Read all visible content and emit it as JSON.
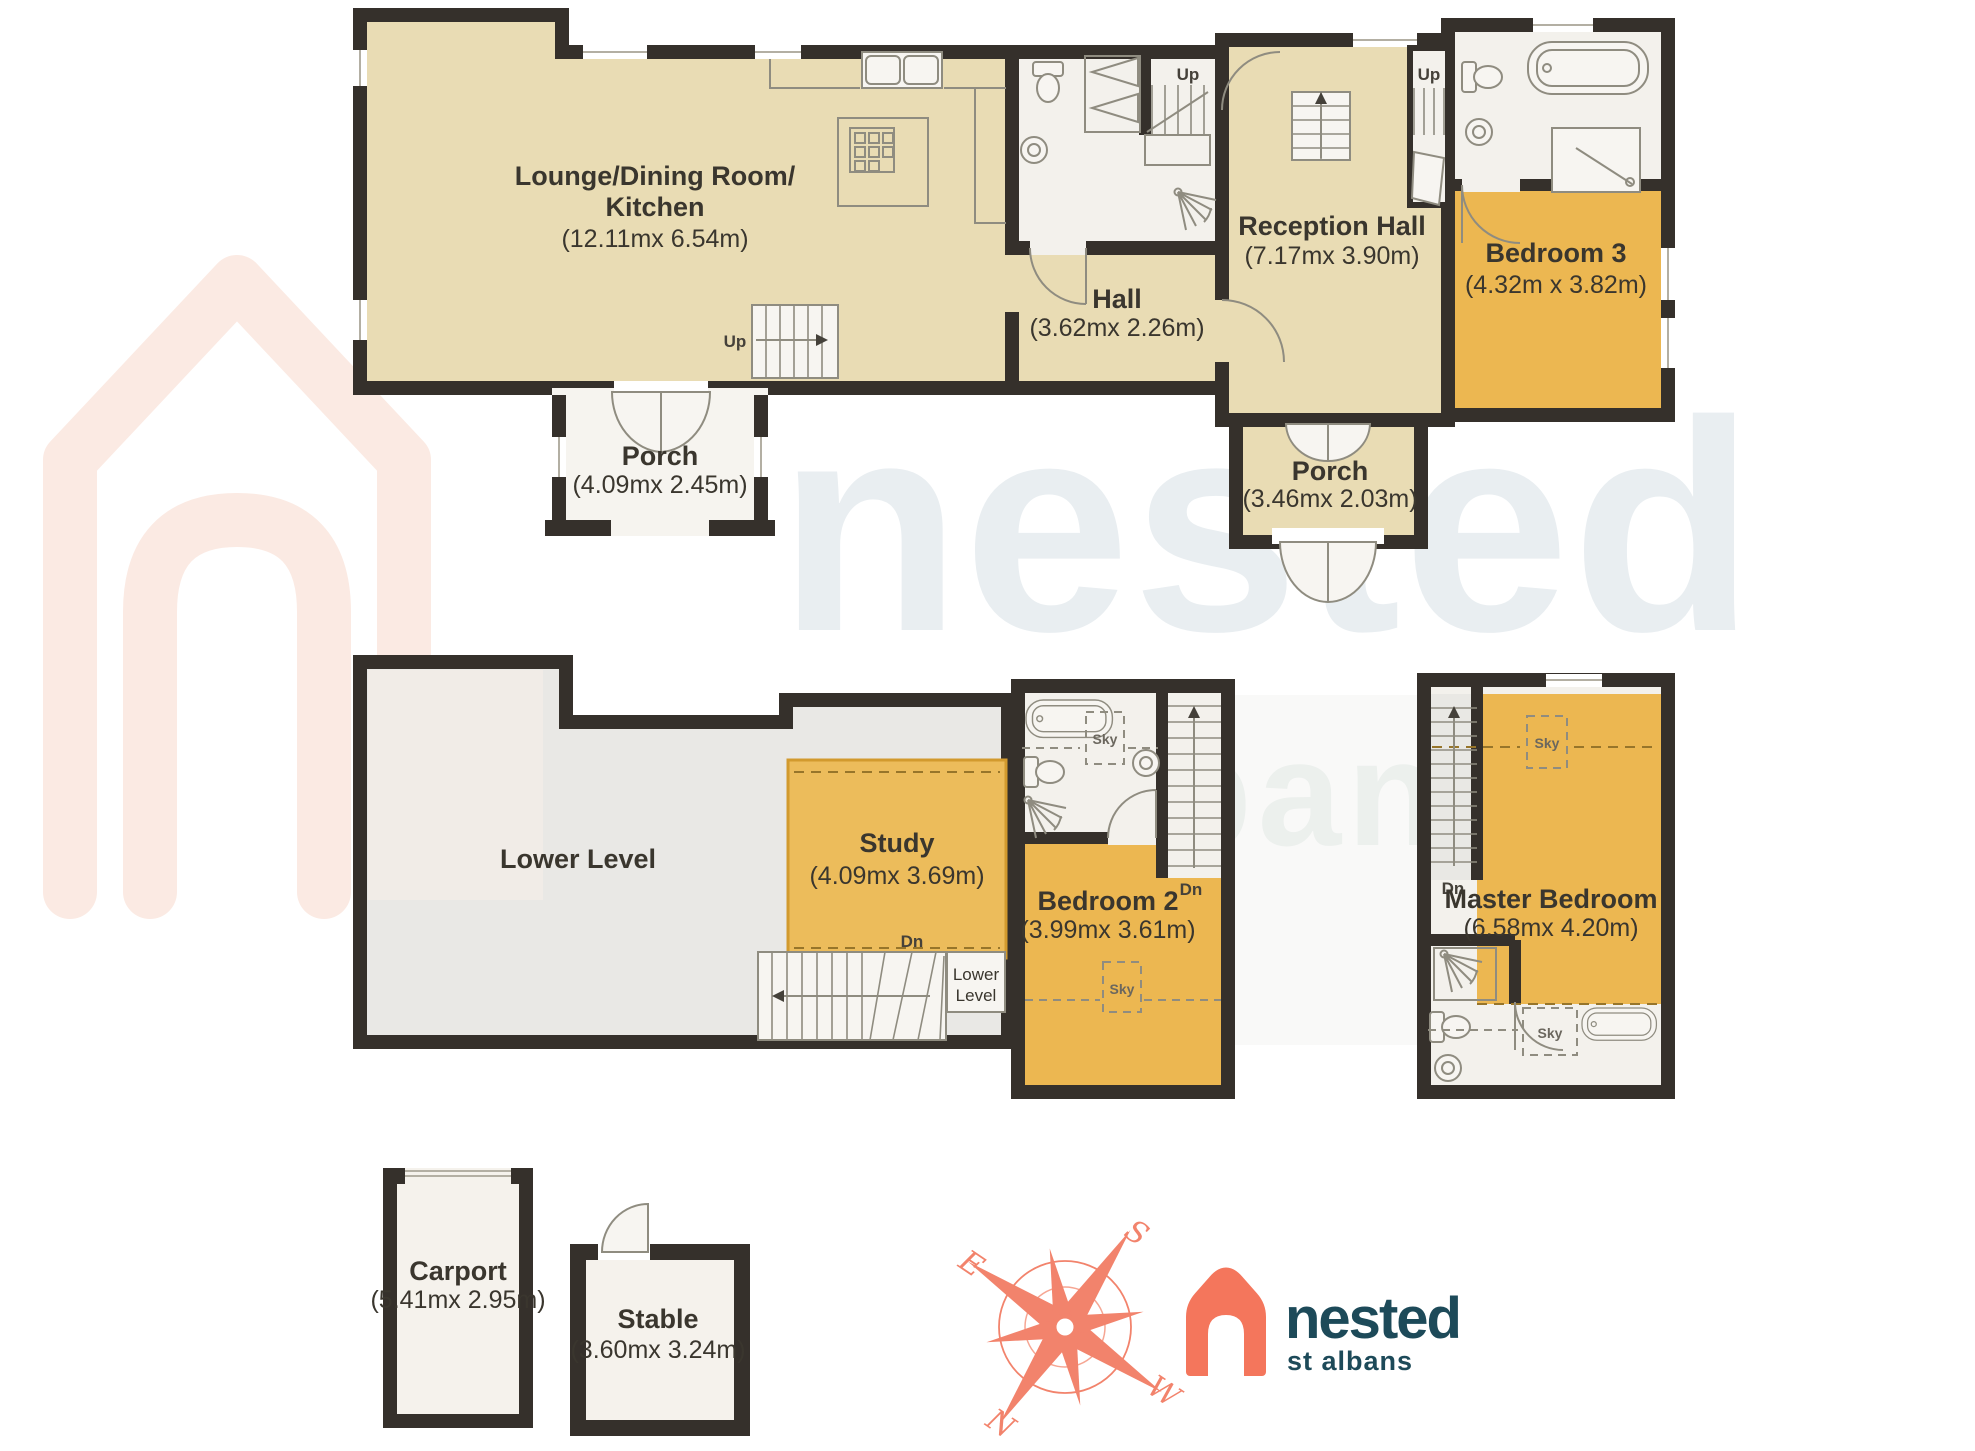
{
  "rooms": {
    "lounge": {
      "name_line1": "Lounge/Dining Room/",
      "name_line2": "Kitchen",
      "dims": "(12.11mx 6.54m)"
    },
    "hall": {
      "name": "Hall",
      "dims": "(3.62mx 2.26m)"
    },
    "reception_hall": {
      "name": "Reception Hall",
      "dims": "(7.17mx 3.90m)"
    },
    "bedroom_3": {
      "name": "Bedroom 3",
      "dims": "(4.32m x 3.82m)"
    },
    "porch_front": {
      "name": "Porch",
      "dims": "(4.09mx 2.45m)"
    },
    "porch_rear": {
      "name": "Porch",
      "dims": "(3.46mx 2.03m)"
    },
    "lower_level": {
      "name": "Lower Level"
    },
    "study": {
      "name": "Study",
      "dims": "(4.09mx 3.69m)"
    },
    "bedroom_2": {
      "name": "Bedroom 2",
      "dims": "(3.99mx 3.61m)"
    },
    "master_bedroom": {
      "name": "Master Bedroom",
      "dims": "(6.58mx 4.20m)"
    },
    "carport": {
      "name": "Carport",
      "dims": "(5.41mx 2.95m)"
    },
    "stable": {
      "name": "Stable",
      "dims": "(3.60mx 3.24m)"
    }
  },
  "annotations": {
    "up": "Up",
    "down": "Dn",
    "sky": "Sky",
    "lower_small_line1": "Lower",
    "lower_small_line2": "Level"
  },
  "compass": {
    "north": "N",
    "south": "S",
    "east": "E",
    "west": "W"
  },
  "logo": {
    "brand": "nested",
    "location": "st albans"
  },
  "watermark": {
    "brand": "nested",
    "location": "st albans"
  },
  "colors": {
    "wall": "#35302b",
    "room_tan": "#e9dcb4",
    "room_orange": "#ecb751",
    "room_white": "#f3f1ec",
    "room_grey": "#e9e8e5",
    "accent_coral": "#f2836c",
    "logo_teal": "#1d4a59",
    "watermark_blue": "#e9eef1",
    "watermark_coral": "#fbeae3"
  }
}
